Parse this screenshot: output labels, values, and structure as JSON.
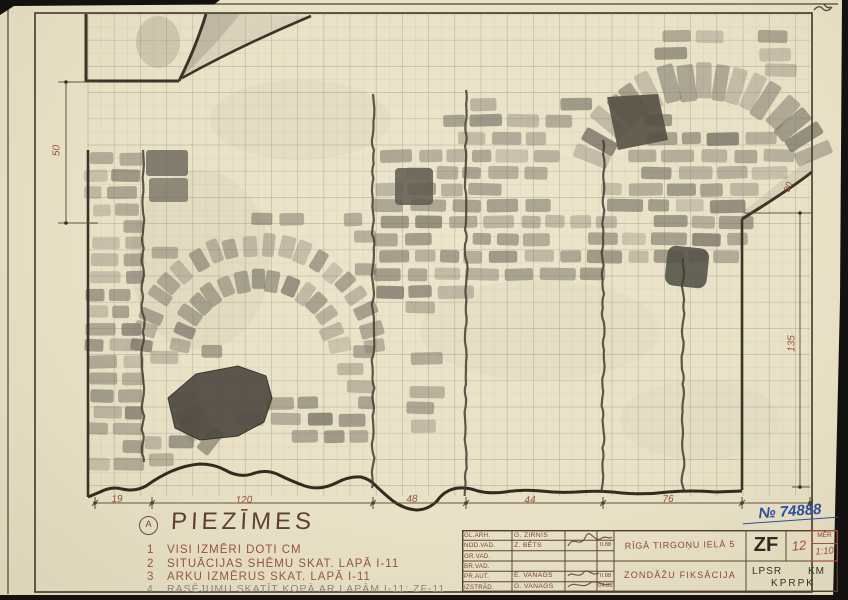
{
  "doc_number": "№ 74888",
  "corner_sheet_no": "2",
  "notes": {
    "marker": "A",
    "title": "PIEZĪMES",
    "items": [
      {
        "num": "1",
        "text": "VISI IZMĒRI DOTI CM"
      },
      {
        "num": "2",
        "text": "SITUĀCIJAS SHĒMU SKAT. LAPĀ I-11"
      },
      {
        "num": "3",
        "text": "ARKU IZMĒRUS SKAT. LAPĀ I-11"
      },
      {
        "num": "4",
        "text": "RASĒJUMU SKATĪT KOPĀ AR LAPĀM I-11; ZF-11"
      }
    ]
  },
  "dimensions": {
    "bottom": [
      "19",
      "120",
      "48",
      "44",
      "76"
    ],
    "left_height": "50",
    "right_height": "135",
    "right_small": "30"
  },
  "titleblock": {
    "rows": [
      {
        "label": "GL.ARH.",
        "name": "G. ZIRNIS",
        "date": ""
      },
      {
        "label": "NOD.VAD.",
        "name": "Z. BĒTS",
        "date": "II.88"
      },
      {
        "label": "GR.VAD.",
        "name": "",
        "date": ""
      },
      {
        "label": "BR.VAD.",
        "name": "",
        "date": ""
      },
      {
        "label": "PR.AUT.",
        "name": "E. VANAGS",
        "date": "II.88"
      },
      {
        "label": "IZSTRĀD.",
        "name": "G. VANAGS",
        "date": "04.88"
      }
    ],
    "object_line": "RĪGĀ TIRGOŅU IELĀ 5",
    "title_line": "ZONDĀŽU FIKSĀCIJA",
    "code": "ZF",
    "sheet_no": "12",
    "scale_label": "MĒR",
    "scale_value": "1:10",
    "org_left": "LPSR",
    "org_right": "KM",
    "org_bottom": "KPRPK"
  },
  "colors": {
    "paper": "#e8e1c6",
    "ink": "#3b3428",
    "red_ink": "#96513d",
    "blue_ink": "#2c4e9b",
    "graphite": "#837d70"
  }
}
